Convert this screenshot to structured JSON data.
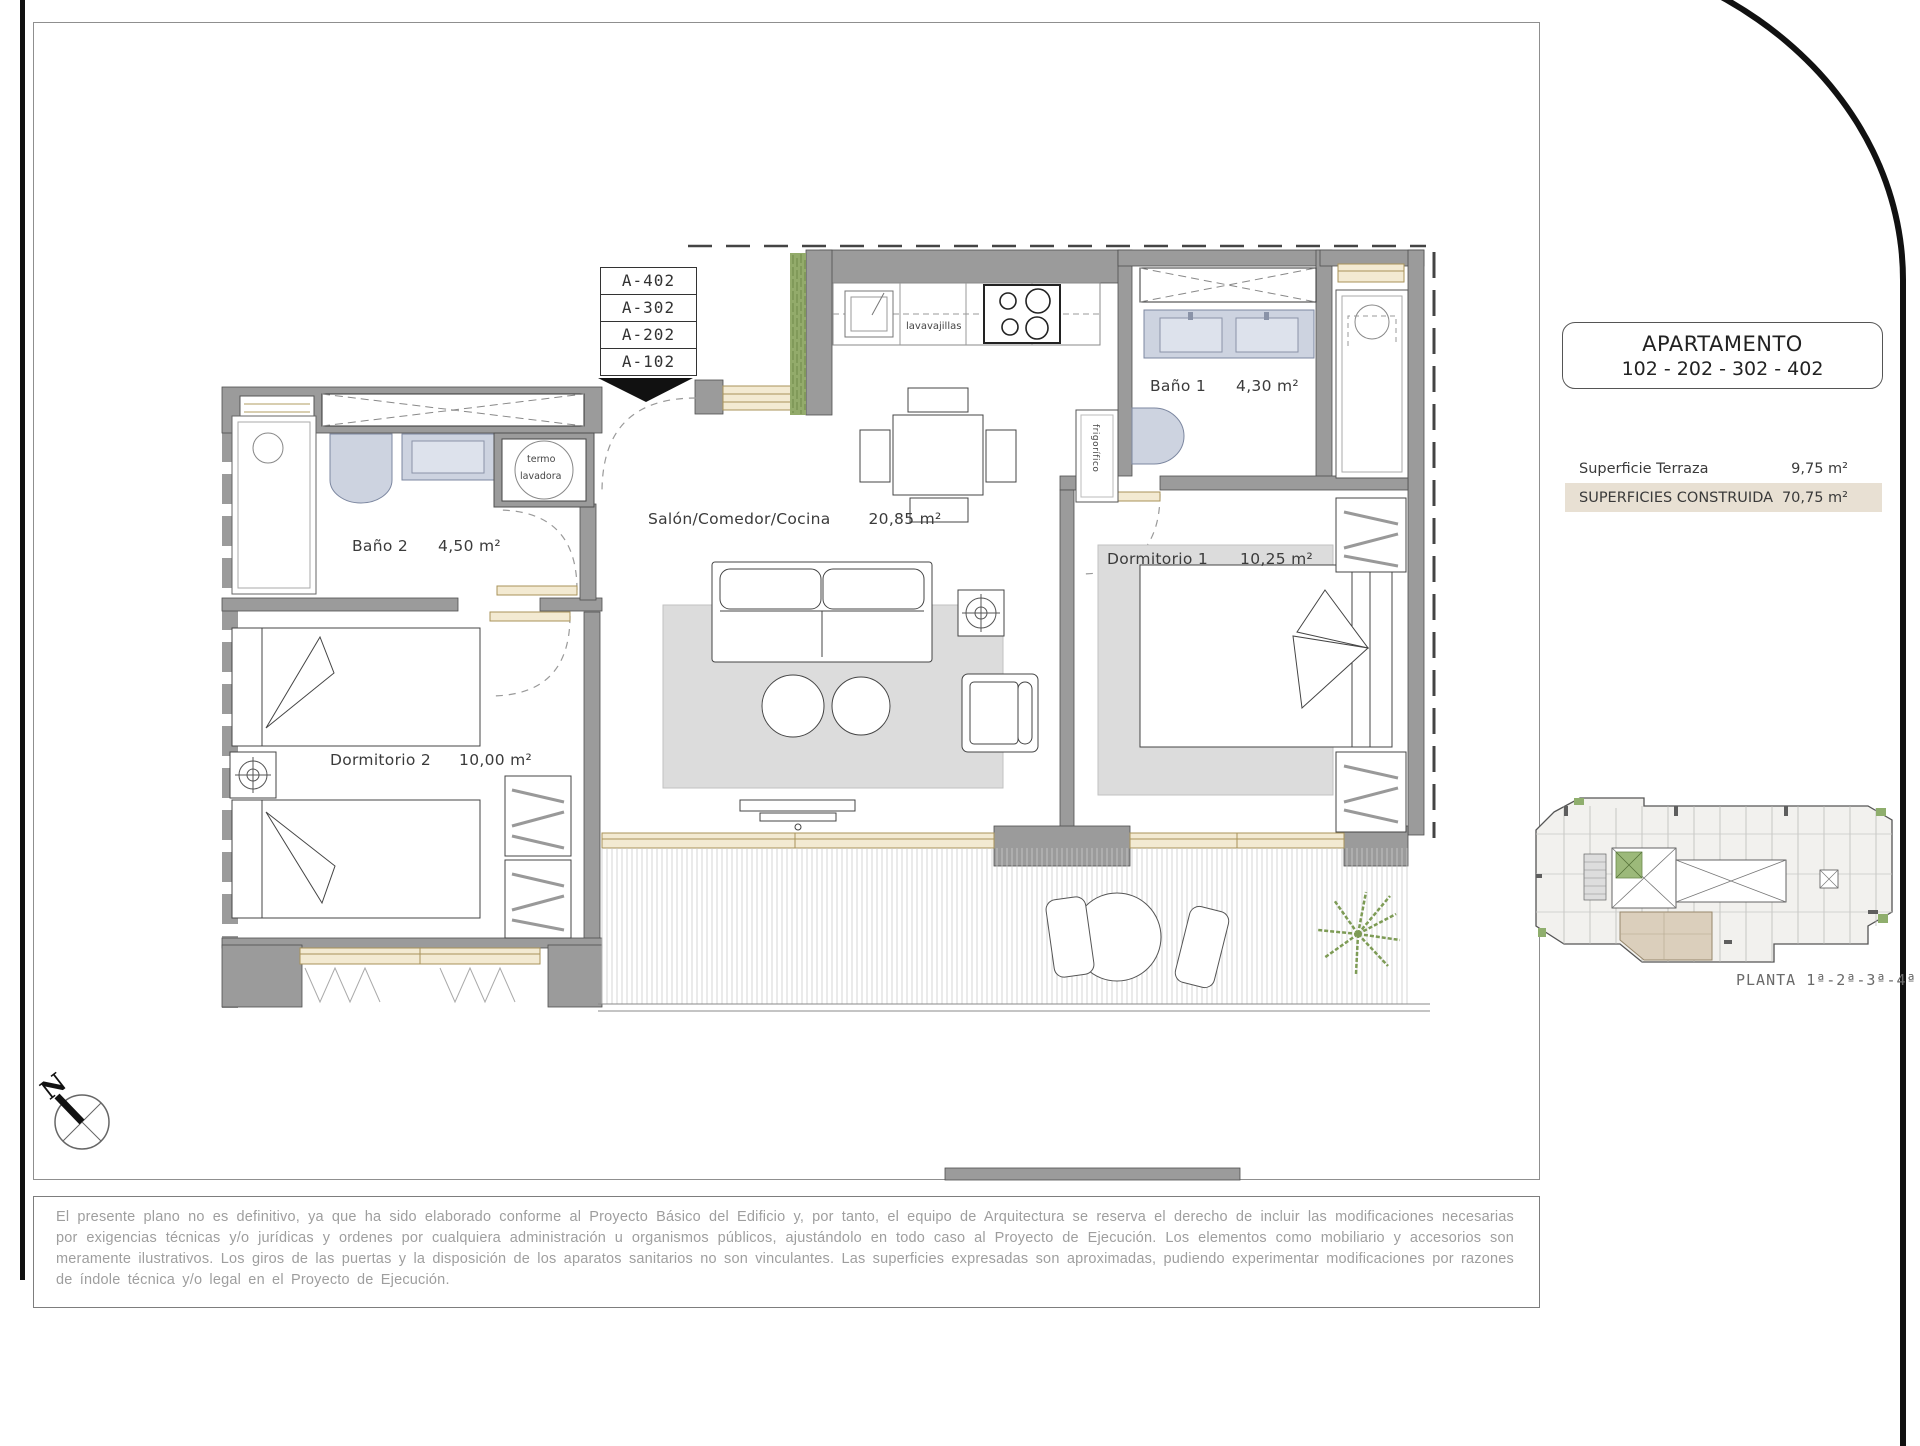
{
  "floor_plan": {
    "entrance_stack": [
      "A-402",
      "A-302",
      "A-202",
      "A-102"
    ],
    "rooms": {
      "bano2": {
        "name": "Baño 2",
        "area": "4,50 m²"
      },
      "dorm2": {
        "name": "Dormitorio 2",
        "area": "10,00 m²"
      },
      "salon": {
        "name": "Salón/Comedor/Cocina",
        "area": "20,85 m²"
      },
      "bano1": {
        "name": "Baño 1",
        "area": "4,30 m²"
      },
      "dorm1": {
        "name": "Dormitorio 1",
        "area": "10,25 m²"
      }
    },
    "labels": {
      "termo_line1": "termo",
      "termo_line2": "lavadora",
      "dishwasher": "lavavajillas",
      "fridge": "frigorífico"
    },
    "north": "N"
  },
  "info_panel": {
    "title": "APARTAMENTO",
    "subtitle": "102 - 202 - 302 - 402",
    "table": {
      "rows": [
        {
          "label": "Superficie Terraza",
          "value": "9,75 m²"
        },
        {
          "label": "SUPERFICIES CONSTRUIDA",
          "value": "70,75 m²"
        }
      ]
    },
    "key_plan_caption": "PLANTA 1ª-2ª-3ª-4ª"
  },
  "disclaimer": "El presente plano no es definitivo, ya que ha sido elaborado conforme al Proyecto Básico del Edificio y, por tanto, el equipo de Arquitectura se reserva el derecho de incluir las modificaciones necesarias por exigencias técnicas y/o jurídicas y ordenes por cualquiera administración u organismos públicos, ajustándolo en todo caso al Proyecto de Ejecución. Los elementos como mobiliario y accesorios son meramente ilustrativos. Los giros de las puertas y la disposición de los aparatos sanitarios no son vinculantes. Las superficies expresadas son aproximadas, pudiendo experimentar modificaciones por razones de índole técnica y/o legal en el Proyecto de Ejecución.",
  "colors": {
    "wall_gray": "#9b9b9b",
    "highlight_row": "#e8e0d3",
    "sanitary_fixture": "#cdd3e0",
    "wood_frame": "#f3ead2",
    "plant_green": "#7d9b55"
  }
}
